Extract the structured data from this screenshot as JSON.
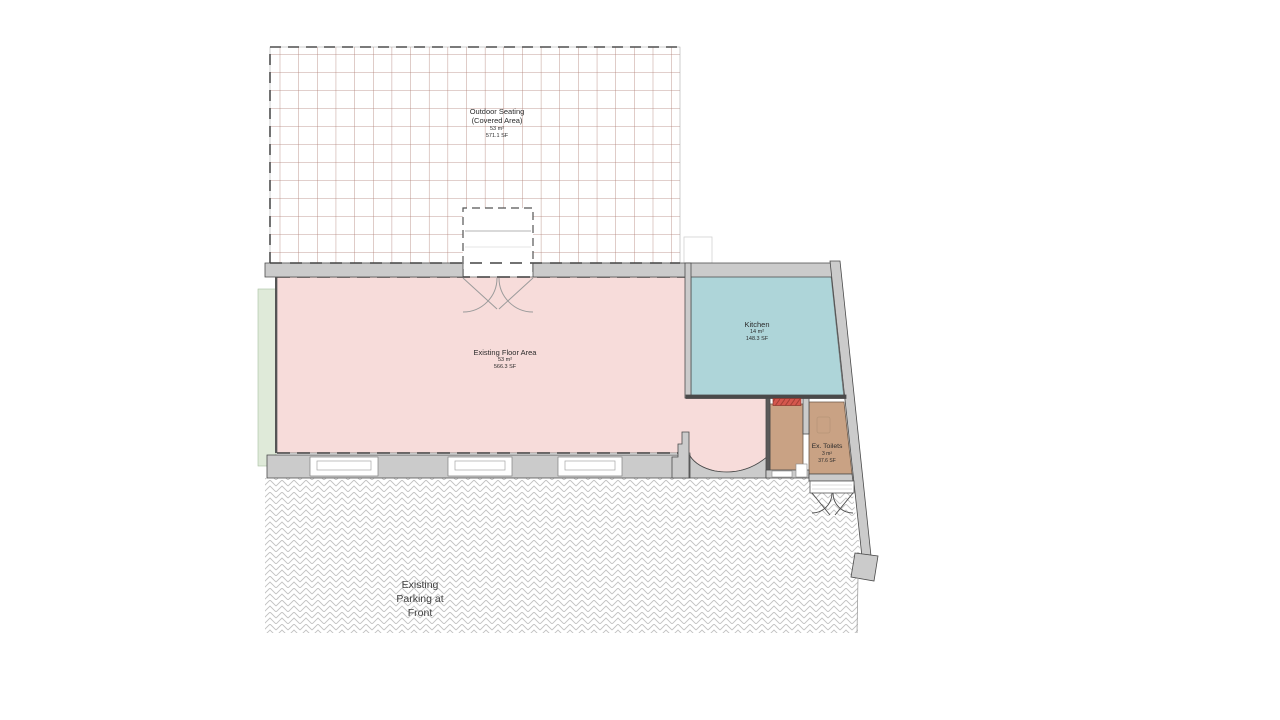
{
  "plan": {
    "outdoor_seating": {
      "name": "Outdoor Seating",
      "qualifier": "(Covered Area)",
      "area_m2": "53 m²",
      "area_sf": "571.1 SF"
    },
    "existing_floor_area": {
      "name": "Existing Floor Area",
      "area_m2": "53 m²",
      "area_sf": "566.3 SF"
    },
    "kitchen": {
      "name": "Kitchen",
      "area_m2": "14 m²",
      "area_sf": "148.3 SF"
    },
    "ex_toilets": {
      "name": "Ex. Toilets",
      "area_m2": "3 m²",
      "area_sf": "37.6 SF"
    },
    "parking": {
      "line1": "Existing",
      "line2": "Parking at",
      "line3": "Front"
    }
  },
  "colors": {
    "existing_floor_fill": "#f7dcda",
    "kitchen_fill": "#aed5d9",
    "toilets_fill": "#c9a284",
    "wall_fill": "#cbcbcb",
    "wall_outline": "#4a4a4a",
    "grid_line": "#b08076",
    "green_strip_fill": "#dfead9",
    "door_marker_red": "#d4574e",
    "hatch_line": "#c2c2c2"
  }
}
